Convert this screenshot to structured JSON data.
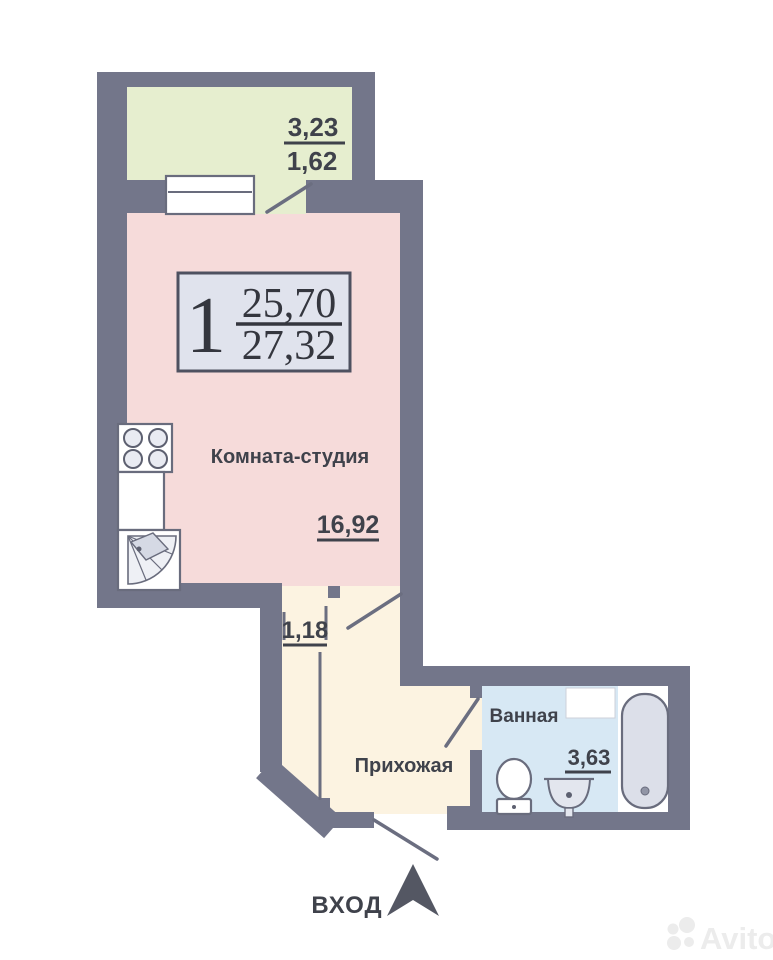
{
  "colors": {
    "wall": "#73768a",
    "balcony_fill": "#e6eecf",
    "studio_fill": "#f6dbda",
    "hallway_fill": "#fcf3e1",
    "bathroom_fill": "#d7e8f4",
    "fixture_fill": "#dcdfe9",
    "badge_fill": "#e0e3ed",
    "text": "#3f424b",
    "watermark": "#ececec"
  },
  "badge": {
    "room_count": "1",
    "living_area": "25,70",
    "total_area": "27,32"
  },
  "balcony": {
    "area": "3,23",
    "area_reduced": "1,62"
  },
  "studio": {
    "name": "Комната-студия",
    "area": "16,92"
  },
  "closet": {
    "area": "1,18"
  },
  "hallway": {
    "name": "Прихожая"
  },
  "bathroom": {
    "name": "Ванная",
    "area": "3,63"
  },
  "entrance": {
    "label": "ВХОД"
  },
  "watermark": {
    "brand": "Avito"
  }
}
